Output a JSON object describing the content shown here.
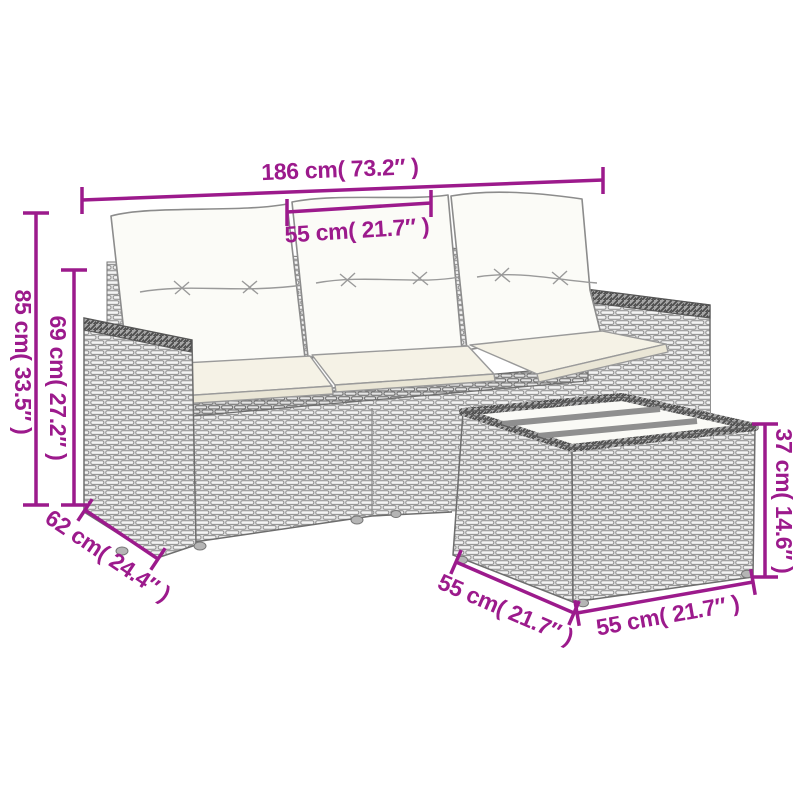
{
  "page": {
    "type": "product-dimension-diagram",
    "subject": "Poly rattan garden sofa set with cushions and ottoman",
    "background": "#ffffff"
  },
  "colors": {
    "dimension_accent": "#9c1a8c",
    "line_art": "#6e6e6e",
    "wicker_base": "#e0e0e0",
    "back_cushion_fill": "#fbfbf7",
    "seat_cushion_fill": "#f5f2e6"
  },
  "dimensions": {
    "sofa_width": "186 cm( 73.2″ )",
    "seat_width": "55 cm( 21.7″ )",
    "sofa_height": "85 cm( 33.5″ )",
    "back_height": "69 cm( 27.2″ )",
    "seat_depth": "62 cm( 24.4″ )",
    "ottoman_height": "37 cm( 14.6″ )",
    "ottoman_depth": "55 cm( 21.7″ )",
    "ottoman_width": "55 cm( 21.7″ )"
  }
}
